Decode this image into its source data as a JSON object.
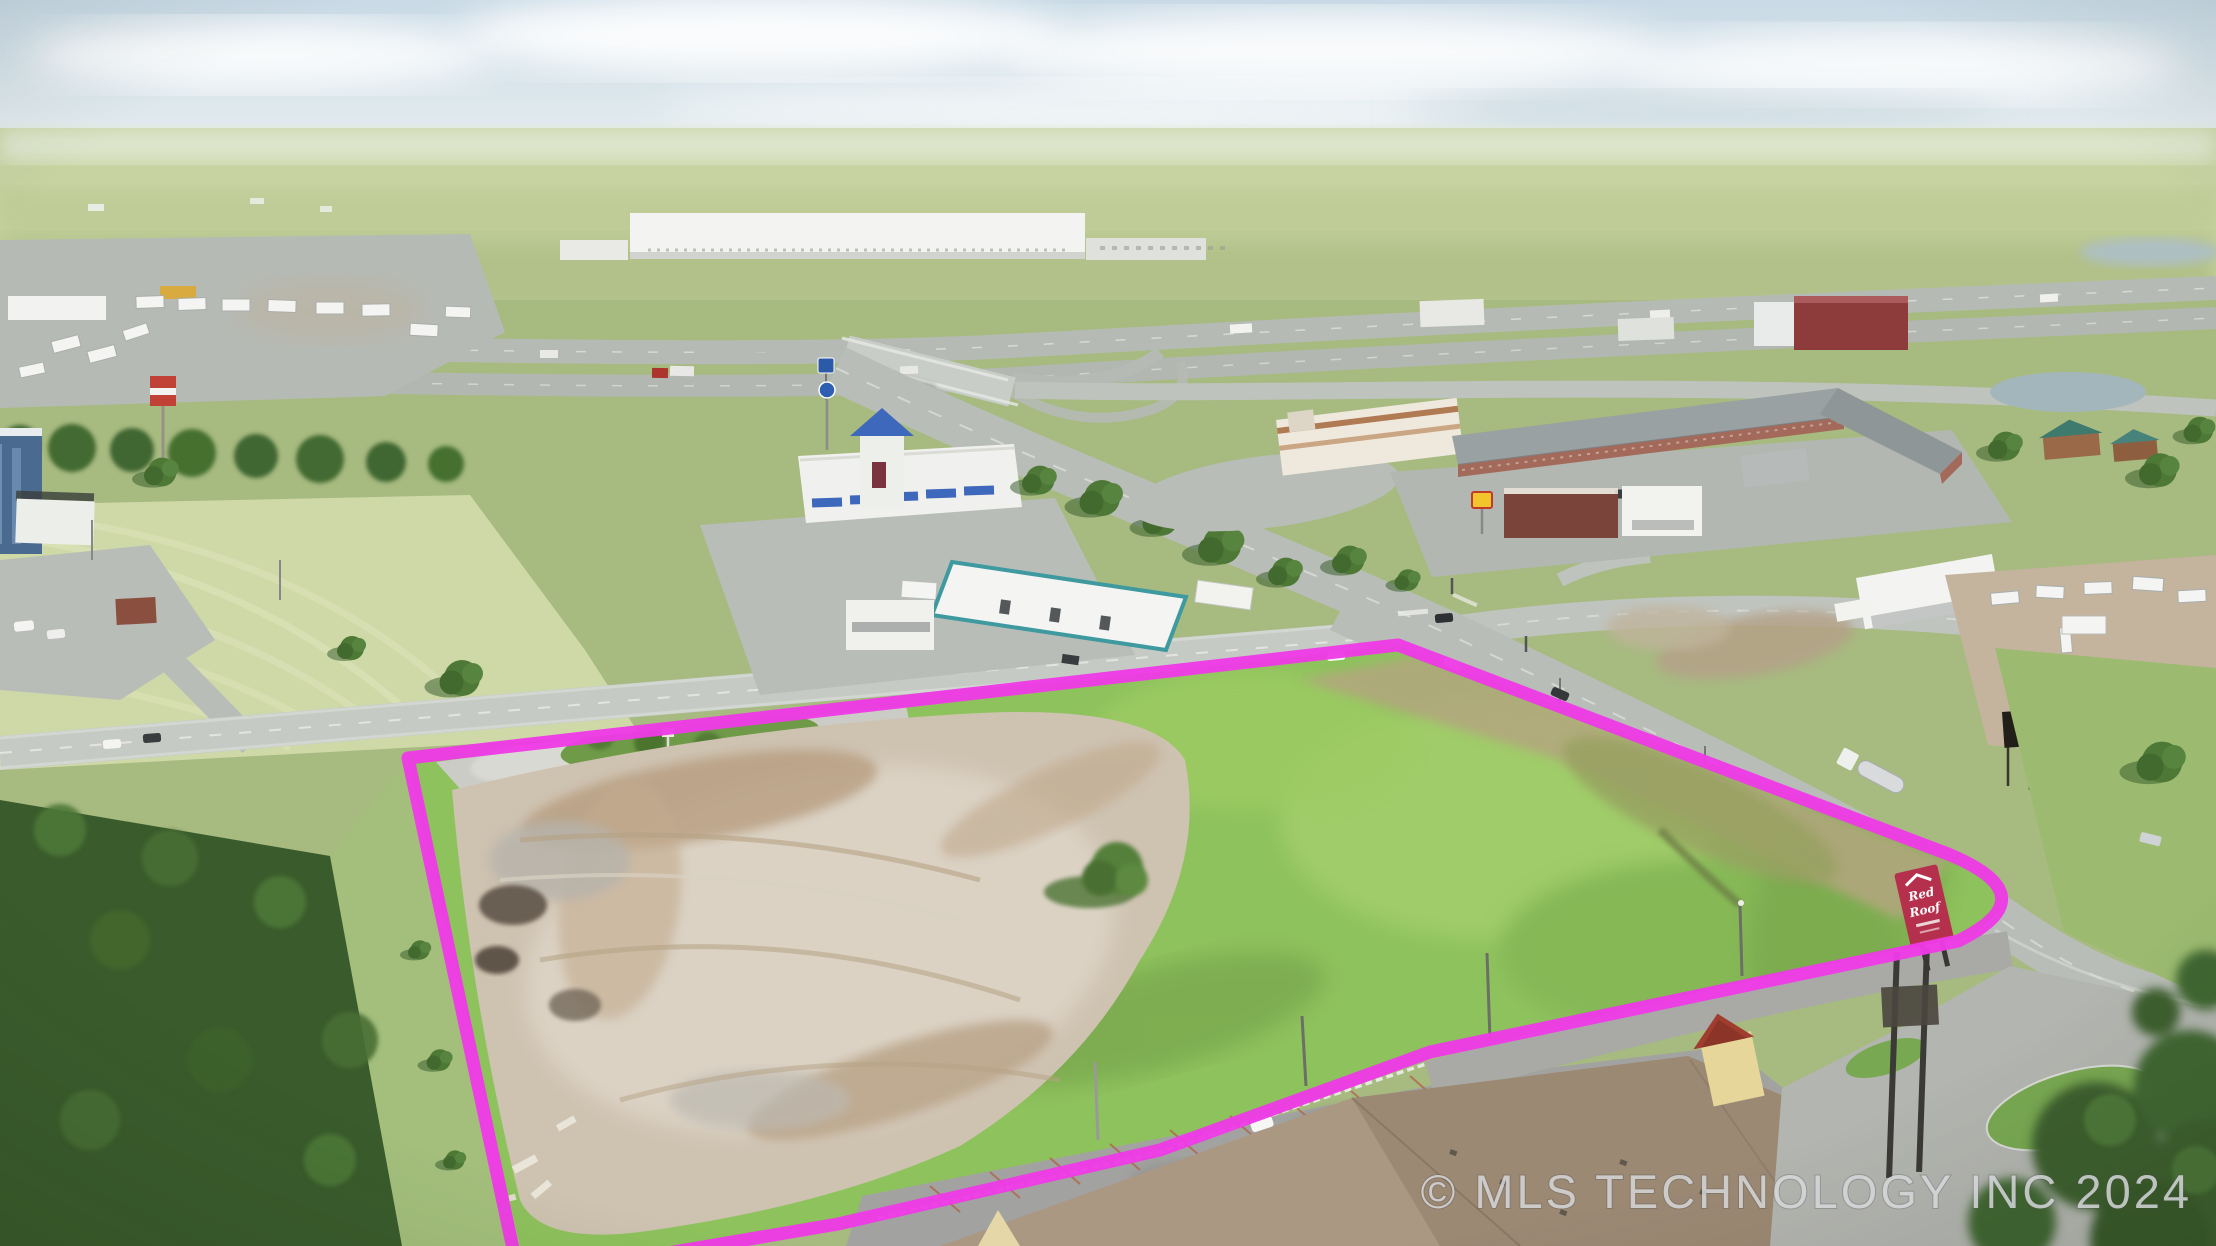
{
  "watermark": {
    "text": "© MLS TECHNOLOGY INC 2024"
  },
  "signs": {
    "big_ad": {
      "label": "BIG AD",
      "bg": "#211f18",
      "fg": "#ecc93a"
    },
    "red_roof": {
      "line1": "Red",
      "line2": "Roof",
      "bg": "#b5304c",
      "fg": "#ffffff"
    }
  },
  "boundary": {
    "path": "M 408 758 L 1398 645 L 1948 854 Q 2050 896 1958 941 L 1430 1052 L 1160 1150 L 838 1224 L 556 1272 L 518 1272 Z",
    "color": "#ee3ae6",
    "width": "13"
  },
  "colors": {
    "parcel_grass": "#8ec25d",
    "dirt_pad": "#cec2b0",
    "road": "#c0c4be",
    "sky": "#d7e3ea",
    "trees": "#3a5c2c",
    "watermark": "#d5d7da"
  }
}
